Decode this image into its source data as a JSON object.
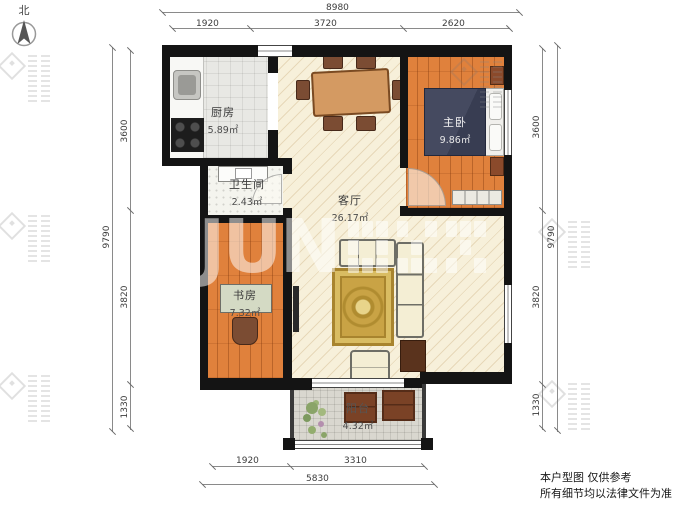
{
  "compass": {
    "label": "北"
  },
  "plan": {
    "rooms": {
      "kitchen": {
        "name": "厨房",
        "area": "5.89㎡"
      },
      "bathroom": {
        "name": "卫生间",
        "area": "2.43㎡"
      },
      "living_room": {
        "name": "客厅",
        "area": "26.17㎡"
      },
      "master_bedroom": {
        "name": "主卧",
        "area": "9.86㎡"
      },
      "study": {
        "name": "书房",
        "area": "7.32㎡"
      },
      "balcony": {
        "name": "阳台",
        "area": "4.32㎡"
      }
    }
  },
  "dimensions": {
    "top": {
      "total": "8980",
      "segments": [
        "1920",
        "3720",
        "2620"
      ]
    },
    "bottom": {
      "total": "5830",
      "segments": [
        "1920",
        "3310"
      ]
    },
    "left": {
      "total": "9790",
      "segments": [
        "3600",
        "3820",
        "1330"
      ]
    },
    "right": {
      "total": "9790",
      "segments": [
        "3600",
        "3820",
        "1330"
      ]
    }
  },
  "watermark": {
    "brand": "JUN"
  },
  "disclaimer": {
    "line1": "本户型图 仅供参考",
    "line2": "所有细节均以法律文件为准"
  },
  "colors": {
    "wall": "#141414",
    "wood_floor": "#e0813c",
    "living_floor": "#f7f0da",
    "bed": "#3d4257",
    "rug": "#c9a345"
  }
}
